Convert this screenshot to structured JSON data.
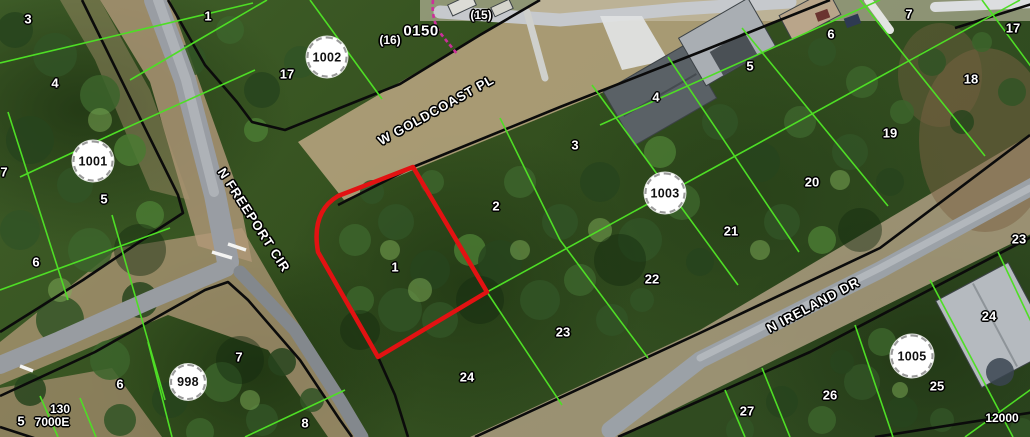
{
  "map": {
    "title": "aerial parcel map",
    "colors": {
      "parcel_line": "#4ede25",
      "right_of_way_line": "#0b0b0b",
      "selected_parcel": "#e21212",
      "utility_line": "#cc2f9a",
      "label_text": "#ffffff",
      "label_halo": "#000000",
      "badge_fill": "#ffffff",
      "road_pavement": "#9aa0a6"
    },
    "selected_parcel": {
      "lot": "1"
    },
    "street_labels": [
      {
        "text": "W GOLDCOAST PL",
        "x": 436,
        "y": 110,
        "rot": -29
      },
      {
        "text": "N FREEPORT CIR",
        "x": 254,
        "y": 220,
        "rot": 57
      },
      {
        "text": "N IRELAND DR",
        "x": 813,
        "y": 305,
        "rot": -28
      }
    ],
    "block_badges": [
      {
        "text": "1001",
        "x": 93,
        "y": 161,
        "d": 37
      },
      {
        "text": "1002",
        "x": 327,
        "y": 57,
        "d": 37
      },
      {
        "text": "1003",
        "x": 665,
        "y": 193,
        "d": 37
      },
      {
        "text": "998",
        "x": 188,
        "y": 382,
        "d": 32
      },
      {
        "text": "1005",
        "x": 912,
        "y": 356,
        "d": 39
      }
    ],
    "lot_labels": [
      {
        "text": "3",
        "x": 28,
        "y": 19
      },
      {
        "text": "4",
        "x": 55,
        "y": 83
      },
      {
        "text": "7",
        "x": 4,
        "y": 172
      },
      {
        "text": "5",
        "x": 104,
        "y": 199
      },
      {
        "text": "6",
        "x": 36,
        "y": 262
      },
      {
        "text": "1",
        "x": 208,
        "y": 16
      },
      {
        "text": "17",
        "x": 287,
        "y": 74
      },
      {
        "text": "5",
        "x": 21,
        "y": 421
      },
      {
        "text": "6",
        "x": 120,
        "y": 384
      },
      {
        "text": "7",
        "x": 239,
        "y": 357
      },
      {
        "text": "8",
        "x": 305,
        "y": 423
      },
      {
        "text": "1",
        "x": 395,
        "y": 267
      },
      {
        "text": "2",
        "x": 496,
        "y": 206
      },
      {
        "text": "3",
        "x": 575,
        "y": 145
      },
      {
        "text": "4",
        "x": 656,
        "y": 97
      },
      {
        "text": "5",
        "x": 750,
        "y": 66
      },
      {
        "text": "6",
        "x": 831,
        "y": 34
      },
      {
        "text": "7",
        "x": 909,
        "y": 14
      },
      {
        "text": "24",
        "x": 467,
        "y": 377
      },
      {
        "text": "23",
        "x": 563,
        "y": 332
      },
      {
        "text": "22",
        "x": 652,
        "y": 279
      },
      {
        "text": "21",
        "x": 731,
        "y": 231
      },
      {
        "text": "20",
        "x": 812,
        "y": 182
      },
      {
        "text": "19",
        "x": 890,
        "y": 133
      },
      {
        "text": "18",
        "x": 971,
        "y": 79
      },
      {
        "text": "17",
        "x": 1013,
        "y": 28
      },
      {
        "text": "27",
        "x": 747,
        "y": 411
      },
      {
        "text": "26",
        "x": 830,
        "y": 395
      },
      {
        "text": "25",
        "x": 937,
        "y": 386
      },
      {
        "text": "24",
        "x": 989,
        "y": 316
      },
      {
        "text": "23",
        "x": 1019,
        "y": 239
      }
    ],
    "dimension_labels": [
      {
        "text": "(16)",
        "x": 390,
        "y": 40,
        "big": false
      },
      {
        "text": "(15)",
        "x": 481,
        "y": 15,
        "big": false
      },
      {
        "text": "0150",
        "x": 421,
        "y": 31,
        "big": true
      },
      {
        "text": "130",
        "x": 60,
        "y": 409,
        "big": false
      },
      {
        "text": "7000E",
        "x": 52,
        "y": 422,
        "big": false
      },
      {
        "text": "12000",
        "x": 1002,
        "y": 418,
        "big": false
      }
    ]
  }
}
